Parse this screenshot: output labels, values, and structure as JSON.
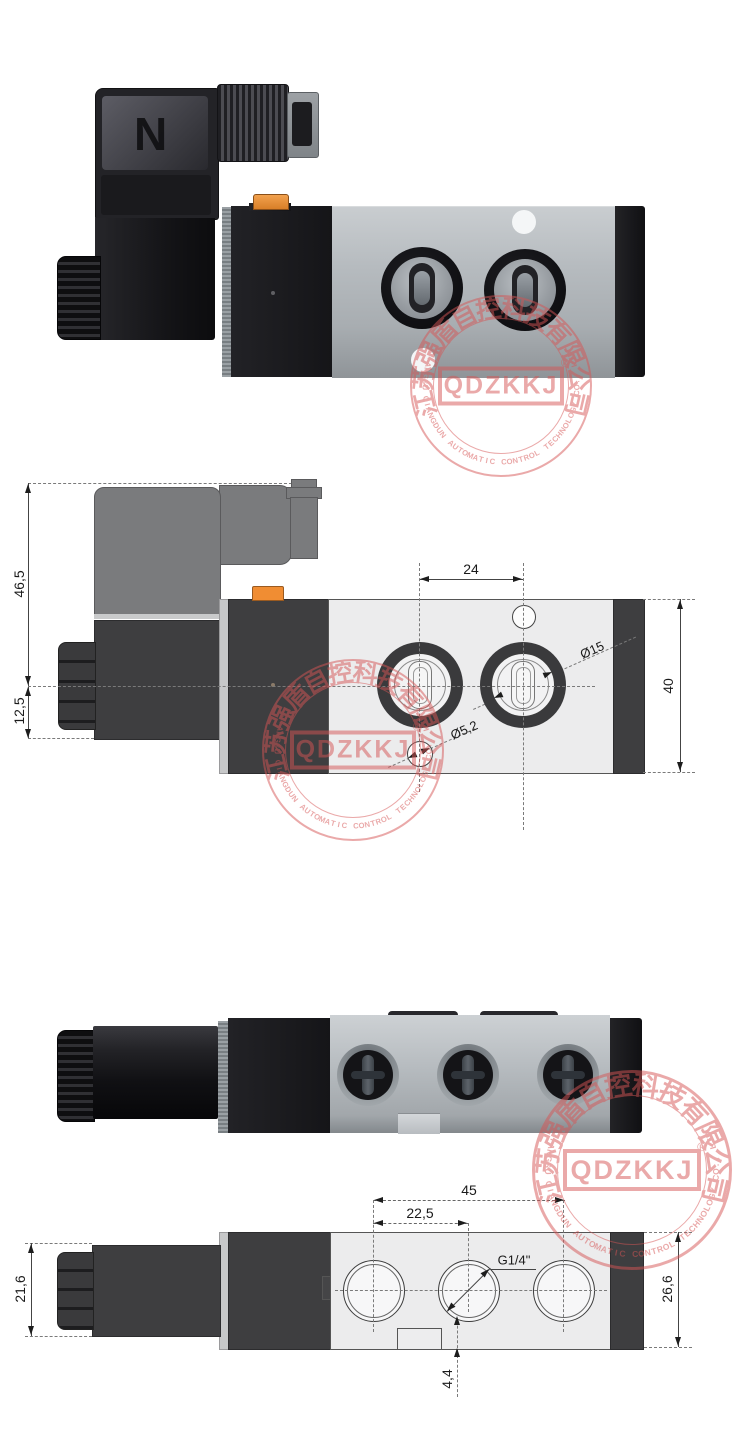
{
  "watermark": {
    "brand": "QDZKKJ",
    "registered": "®",
    "cn": "江苏强盾自控科技有限公司",
    "en": "JIANGSU QIANGDUN AUTOMATIC CONTROL TECHNOLOGY CO., LTD",
    "color": "#d65555",
    "stamps": [
      {
        "cx": 501,
        "cy": 386,
        "r": 91
      },
      {
        "cx": 353,
        "cy": 750,
        "r": 91
      },
      {
        "cx": 632,
        "cy": 1170,
        "r": 100
      }
    ]
  },
  "photo_top": {
    "coil_marking": "N",
    "indicator_color": "#f08d33"
  },
  "drawing_side": {
    "dims": {
      "total_height": "46,5",
      "lower_height": "12,5",
      "port_spacing": "24",
      "port_diameter": "Ø15",
      "pilot_diameter": "Ø5,2",
      "body_height": "40"
    }
  },
  "photo_bottom": {},
  "drawing_bottom": {
    "dims": {
      "outer_spacing": "45",
      "half_spacing": "22,5",
      "thread": "G1/4\"",
      "coil_width": "21,6",
      "body_width": "26,6",
      "pilot_offset": "4,4"
    }
  }
}
